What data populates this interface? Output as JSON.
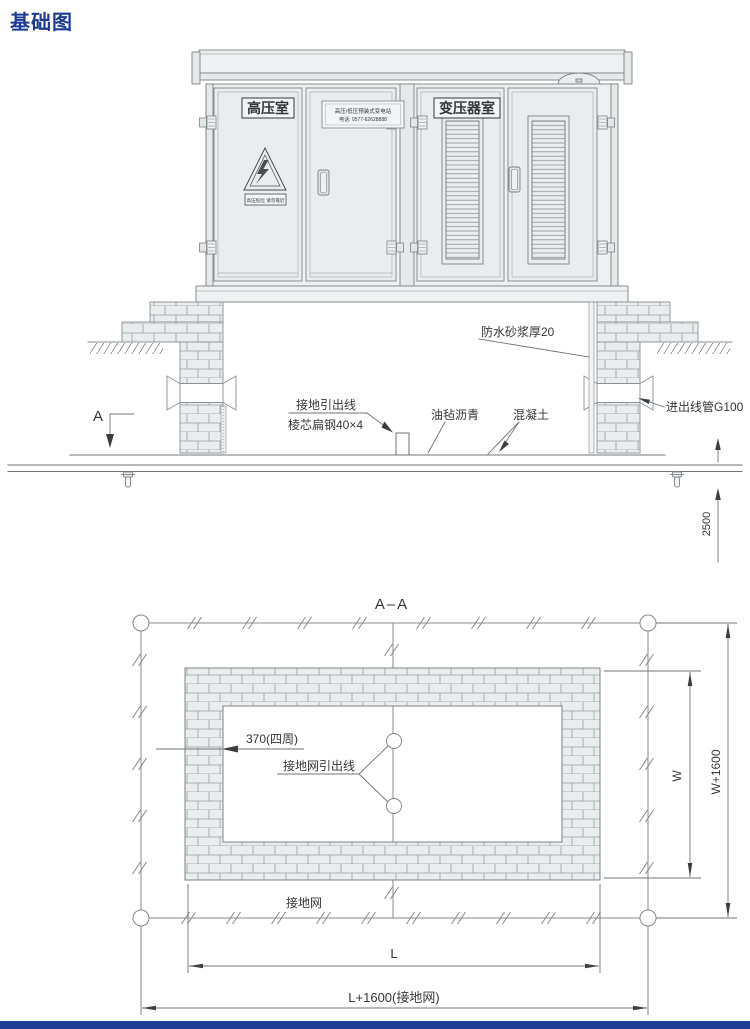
{
  "page": {
    "title": "基础图",
    "accent_color": "#1c3c94",
    "line_color": "#7d8285"
  },
  "elevation": {
    "rooms": {
      "hv_room": "高压室",
      "transformer_room": "变压器室"
    },
    "nameplate": {
      "line1": "高压/低压预装式变电站",
      "line2": "电话: 0577-62628888"
    },
    "warning_plate": "高压危险 请勿靠近",
    "annotations": {
      "ground_lead_line": "接地引出线",
      "flat_steel": "棱芯扁钢40×4",
      "asphalt_felt": "油毡沥青",
      "concrete": "混凝土",
      "waterproof_mortar": "防水砂浆厚20",
      "conduit": "进出线管G100",
      "section_marker": "A",
      "depth_dimension": "2500"
    }
  },
  "plan": {
    "title": "A–A",
    "annotations": {
      "wall_thickness": "370(四周)",
      "grid_lead_line": "接地网引出线",
      "ground_grid": "接地网",
      "dim_inner_width": "W",
      "dim_outer_width": "W+1600",
      "dim_inner_length": "L",
      "dim_outer_length": "L+1600(接地网)"
    }
  }
}
